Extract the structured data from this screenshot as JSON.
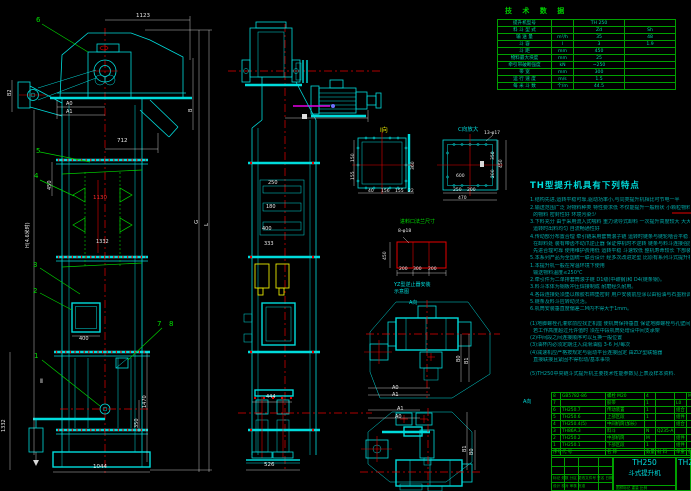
{
  "tech_table": {
    "title": "技 术 数 据",
    "rows": [
      [
        "提升机型号",
        "",
        "TH 250",
        ""
      ],
      [
        "料 斗 型 式",
        "",
        "Zd",
        "Sh"
      ],
      [
        "输 送 量",
        "m³/h",
        "35",
        "48"
      ],
      [
        "斗  容",
        "l",
        "3",
        "1.9"
      ],
      [
        "斗  距",
        "mm",
        "450",
        ""
      ],
      [
        "物料最大块度",
        "mm",
        "25",
        ""
      ],
      [
        "牵引带破断强度",
        "kN",
        "~250",
        ""
      ],
      [
        "带  宽",
        "mm",
        "300",
        ""
      ],
      [
        "运 行 速 度",
        "m/s",
        "1.5",
        ""
      ],
      [
        "每 米 斗 数",
        "个/m",
        "44.5",
        ""
      ]
    ]
  },
  "notes": {
    "title": "TH型提升机具有下列特点",
    "lines": [
      "1.结构先进,运转平稳可靠,驱动功率小,与同类提升机相比可节电一半",
      "2.输送范围广泛 对物料种类 特性要求低 不仅能提升一般粉状 小颗粒物料 也可提升磨琢性较大",
      "  的物料 密封性好 环境污染少",
      "3.下料充分 由于采用流入式喂料 重力诱导式卸料 一次提升高度较大 大大减少回料 动力消耗低",
      "  运转时出料均匀 自流畅通性好",
      "4.传动部分布置合理 牵引链采用套筒滚子链 运转时链条与链轮啮合平稳 工作噪音小卸料干净",
      "  在卸料处 装有带齿不动爪逆止器 保证停机时不逆转 链条与料斗连接强度高 工具拆装方便耐用",
      "  先进合理可靠 使用维护费用低 运转平稳 斗速较低 整机寿命较长 下部装有张紧装置",
      "5.本系列产品为全国统一联合设计 经多次改进定型 比原有系列斗式提升机的性能指标先进 可靠",
      "1.本提升机一般在常温环境下使用",
      "  输送物料温度≤250℃",
      "2.牵引件为二单排套筒滚子链 D1级(中碳钢)和 D4(链条钢)。",
      "3.料斗本体为钢板冲压焊接制成 耐磨经久耐用。",
      "4.各段连接处须垫以橡胶石棉垫密封 用户安装前应涂以由铅油与石墨粉调和的密封膏再行联接",
      "5.链条及料斗应转动灵活。",
      "6.机筒安装垂直度偏差二M内不得大于1mm。",
      "",
      "(1)地脚螺栓孔灌浆前应找正机座 使机筒保持垂直 保证地脚螺栓与孔壁间距均匀",
      "  若工作高度超过允许值时 须在中段机筒处增设中间支承架",
      "(2)中间段之间连接顺序可以互换一般位置",
      "(3)油杯内必须定期注入润滑油脂 3-6 月/每次",
      "(4)减速机应严格按规定与驱动平台连接固定 由ZLY型联轴器",
      "  直接联接且紧固不得松动/基本事项",
      "",
      "(5)TH250中央链斗式提升机主要技术性能参数见上表及样本资料."
    ]
  },
  "bom": {
    "header": [
      "序号",
      "代  号",
      "名  称",
      "数量",
      "材 料",
      "单重",
      "备注"
    ],
    "rows": [
      [
        "8",
        "GB5782-86",
        "螺栓 M20",
        "4",
        "",
        "",
        "M20"
      ],
      [
        "7",
        "",
        "胶带",
        "1",
        "",
        "L0",
        ""
      ],
      [
        "6",
        "TH250.7",
        "传动装置",
        "1",
        "",
        "组合",
        ""
      ],
      [
        "5",
        "TH250.6",
        "上部区段",
        "1",
        "",
        "组件",
        ""
      ],
      [
        "4",
        "TH250.4(5)",
        "中间机筒(加长)",
        "",
        "",
        "组合",
        ""
      ],
      [
        "3",
        "TH86A.3",
        "料斗",
        "N",
        "Q235-A",
        "",
        ""
      ],
      [
        "2",
        "TH250.2",
        "中部机筒",
        "M",
        "",
        "组件",
        ""
      ],
      [
        "1",
        "TH250.1",
        "下部区段",
        "1",
        "",
        "组件",
        ""
      ]
    ]
  },
  "title_block": {
    "model": "TH250",
    "name": "斗式提升机",
    "model_right": "TH2",
    "rev_line": "标记 处数 分区 更改文件号 签名 日期",
    "sign_line": "设计   校对   审核   批准",
    "scale_line": "图样标记   重量   比例"
  },
  "labels": [
    {
      "x": 136,
      "y": 14,
      "t": "1123",
      "s": 5.5
    },
    {
      "x": 117,
      "y": 139,
      "t": "712",
      "s": 5.5
    },
    {
      "x": 66,
      "y": 102,
      "t": "A0",
      "s": 5
    },
    {
      "x": 66,
      "y": 110,
      "t": "A1",
      "s": 5
    },
    {
      "x": 36,
      "y": 17,
      "t": "6",
      "c": "green",
      "s": 7
    },
    {
      "x": 36,
      "y": 148,
      "t": "5",
      "c": "green",
      "s": 7
    },
    {
      "x": 8,
      "y": 96,
      "t": "B2",
      "r": -90,
      "s": 5
    },
    {
      "x": 189,
      "y": 112,
      "t": "B",
      "r": -90,
      "s": 5
    },
    {
      "x": 34,
      "y": 173,
      "t": "4",
      "c": "green",
      "s": 7
    },
    {
      "x": 48,
      "y": 190,
      "t": "450",
      "r": -90,
      "s": 5
    },
    {
      "x": 93,
      "y": 196,
      "t": "1130",
      "c": "red",
      "s": 5.5
    },
    {
      "x": 96,
      "y": 240,
      "t": "1332",
      "s": 5
    },
    {
      "x": 33,
      "y": 262,
      "t": "3",
      "c": "green",
      "s": 7
    },
    {
      "x": 33,
      "y": 288,
      "t": "2",
      "c": "green",
      "s": 7
    },
    {
      "x": 26,
      "y": 248,
      "t": "H(4.6米时)",
      "r": -90,
      "s": 5
    },
    {
      "x": 34,
      "y": 353,
      "t": "1",
      "c": "green",
      "s": 7
    },
    {
      "x": 157,
      "y": 321,
      "t": "7",
      "c": "green",
      "s": 7
    },
    {
      "x": 169,
      "y": 321,
      "t": "8",
      "c": "green",
      "s": 7
    },
    {
      "x": 79,
      "y": 337,
      "t": "400",
      "s": 5
    },
    {
      "x": 143,
      "y": 408,
      "t": "1470",
      "r": -90,
      "s": 5
    },
    {
      "x": 135,
      "y": 428,
      "t": "350",
      "r": -90,
      "s": 5
    },
    {
      "x": 2,
      "y": 432,
      "t": "1332",
      "r": -90,
      "s": 5
    },
    {
      "x": 93,
      "y": 465,
      "t": "1044",
      "s": 5.5
    },
    {
      "x": 195,
      "y": 224,
      "t": "G",
      "r": -90,
      "s": 5.5
    },
    {
      "x": 205,
      "y": 226,
      "t": "L",
      "r": -90,
      "s": 5.5
    },
    {
      "x": 40,
      "y": 379,
      "t": "Ⅱ",
      "s": 6
    },
    {
      "x": 268,
      "y": 181,
      "t": "250",
      "s": 5
    },
    {
      "x": 266,
      "y": 205,
      "t": "180",
      "s": 5
    },
    {
      "x": 262,
      "y": 227,
      "t": "400",
      "s": 5
    },
    {
      "x": 264,
      "y": 242,
      "t": "333",
      "s": 5
    },
    {
      "x": 266,
      "y": 395,
      "t": "444",
      "s": 5
    },
    {
      "x": 264,
      "y": 463,
      "t": "526",
      "s": 5.5
    },
    {
      "x": 380,
      "y": 128,
      "t": "Ⅰ向",
      "c": "yellow",
      "s": 6
    },
    {
      "x": 352,
      "y": 162,
      "t": "150",
      "r": -90,
      "s": 4.5
    },
    {
      "x": 352,
      "y": 180,
      "t": "155",
      "r": -90,
      "s": 4.5
    },
    {
      "x": 412,
      "y": 170,
      "t": "360",
      "r": -90,
      "s": 4.5
    },
    {
      "x": 368,
      "y": 190,
      "t": "40",
      "s": 4.5
    },
    {
      "x": 381,
      "y": 190,
      "t": "156",
      "s": 4.5
    },
    {
      "x": 395,
      "y": 190,
      "t": "155",
      "s": 4.5
    },
    {
      "x": 408,
      "y": 190,
      "t": "22",
      "s": 4.5
    },
    {
      "x": 458,
      "y": 128,
      "t": "C向放大",
      "c": "cyan",
      "s": 5.5
    },
    {
      "x": 484,
      "y": 132,
      "t": "13-φ17",
      "s": 4.5
    },
    {
      "x": 456,
      "y": 175,
      "t": "600",
      "s": 4.5
    },
    {
      "x": 453,
      "y": 189,
      "t": "250",
      "s": 4.5
    },
    {
      "x": 467,
      "y": 189,
      "t": "200",
      "s": 4.5
    },
    {
      "x": 458,
      "y": 197,
      "t": "470",
      "s": 4.5
    },
    {
      "x": 492,
      "y": 160,
      "t": "350",
      "r": -90,
      "s": 4.5
    },
    {
      "x": 492,
      "y": 178,
      "t": "200",
      "r": -90,
      "s": 4.5
    },
    {
      "x": 500,
      "y": 168,
      "t": "450",
      "r": -90,
      "s": 4.5
    },
    {
      "x": 400,
      "y": 220,
      "t": "进料口法兰尺寸",
      "c": "green",
      "s": 5
    },
    {
      "x": 398,
      "y": 230,
      "t": "8-φ18",
      "s": 4.5
    },
    {
      "x": 384,
      "y": 260,
      "t": "450",
      "r": -90,
      "s": 4.5
    },
    {
      "x": 399,
      "y": 268,
      "t": "200",
      "s": 4.5
    },
    {
      "x": 413,
      "y": 268,
      "t": "300",
      "s": 4.5
    },
    {
      "x": 428,
      "y": 268,
      "t": "200",
      "s": 4.5
    },
    {
      "x": 394,
      "y": 283,
      "t": "YZ型逆止器安装",
      "c": "cyan",
      "s": 5
    },
    {
      "x": 394,
      "y": 290,
      "t": "示意图",
      "c": "cyan",
      "s": 5
    },
    {
      "x": 409,
      "y": 301,
      "t": "A向",
      "c": "cyan",
      "s": 5
    },
    {
      "x": 392,
      "y": 386,
      "t": "A0",
      "s": 5
    },
    {
      "x": 392,
      "y": 393,
      "t": "A1",
      "s": 5
    },
    {
      "x": 457,
      "y": 362,
      "t": "B0",
      "r": -90,
      "s": 5
    },
    {
      "x": 465,
      "y": 364,
      "t": "B1",
      "r": -90,
      "s": 5
    },
    {
      "x": 397,
      "y": 407,
      "t": "A1",
      "s": 5
    },
    {
      "x": 395,
      "y": 415,
      "t": "A0",
      "s": 5
    },
    {
      "x": 463,
      "y": 452,
      "t": "B1",
      "r": -90,
      "s": 5
    },
    {
      "x": 470,
      "y": 455,
      "t": "B0",
      "r": -90,
      "s": 5
    },
    {
      "x": 523,
      "y": 400,
      "t": "A向",
      "c": "cyan",
      "s": 5
    }
  ]
}
